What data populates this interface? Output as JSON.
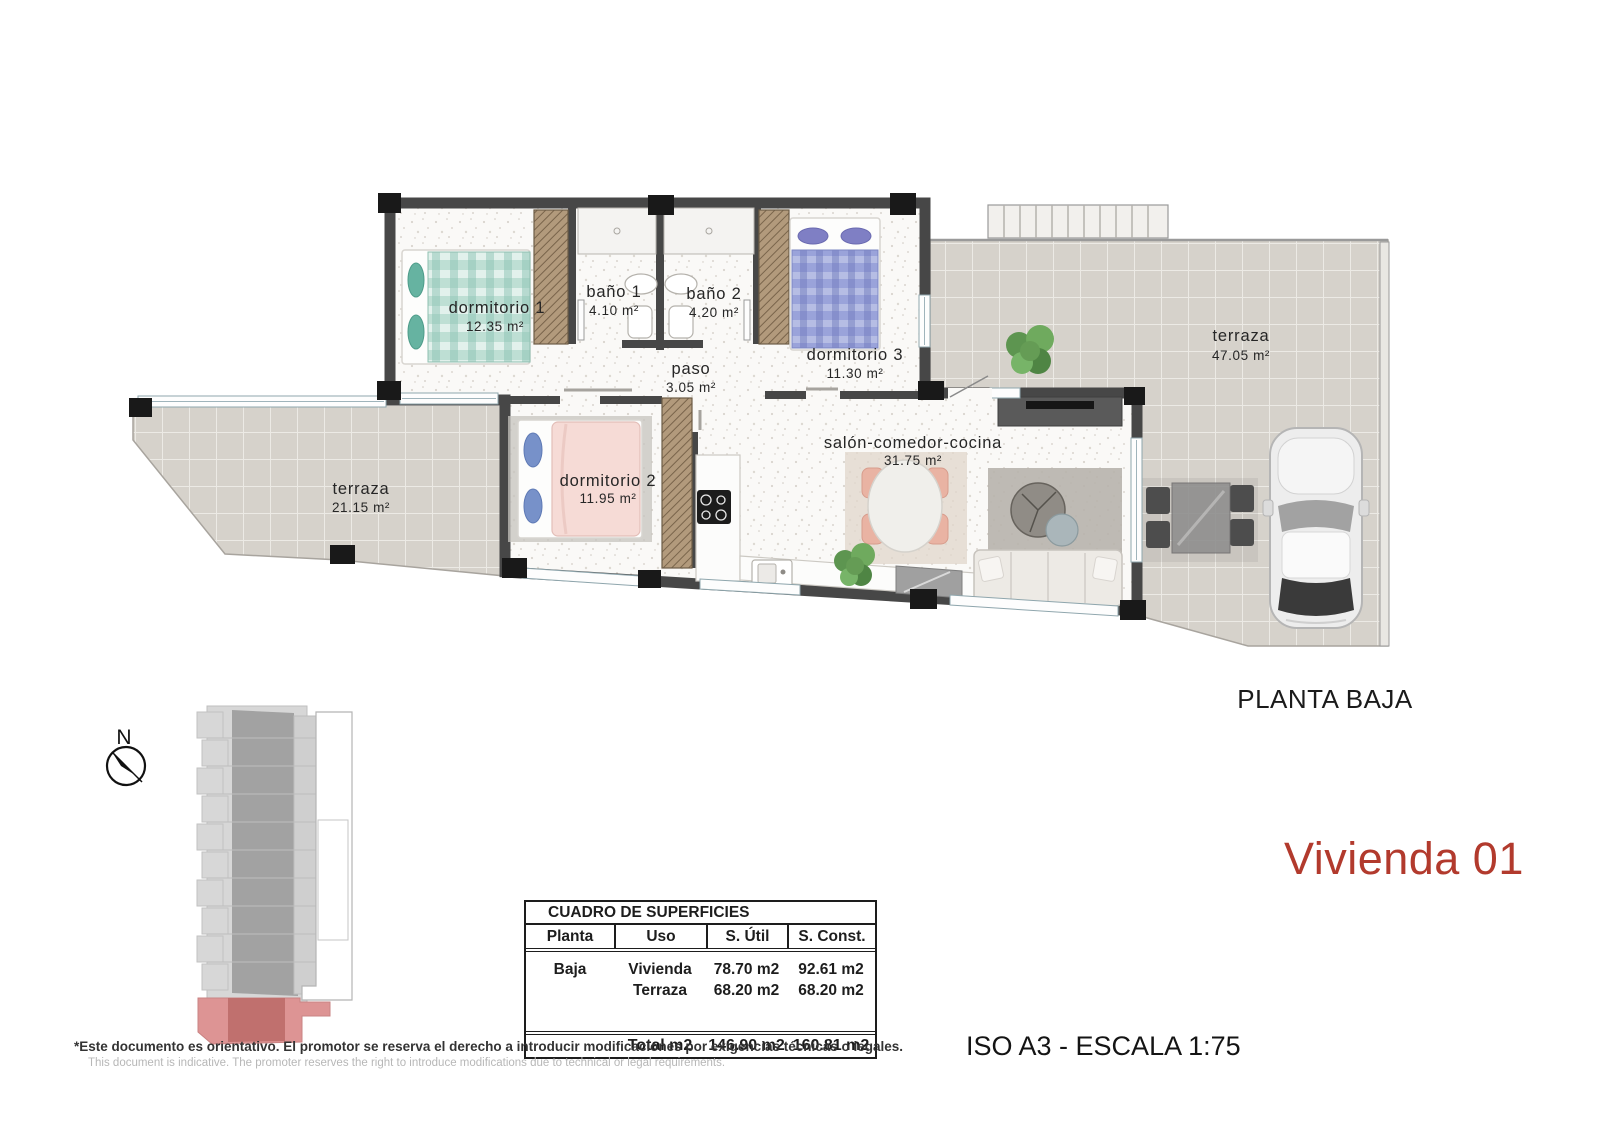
{
  "plan": {
    "compass": "N",
    "floor_label": "PLANTA BAJA",
    "unit_label": "Vivienda 01",
    "scale_label": "ISO A3 - ESCALA 1:75",
    "rooms": [
      {
        "name": "dormitorio  1",
        "area": "12.35  m²"
      },
      {
        "name": "baño  1",
        "area": "4.10  m²"
      },
      {
        "name": "baño  2",
        "area": "4.20  m²"
      },
      {
        "name": "paso",
        "area": "3.05  m²"
      },
      {
        "name": "dormitorio  3",
        "area": "11.30  m²"
      },
      {
        "name": "dormitorio  2",
        "area": "11.95  m²"
      },
      {
        "name": "salón-comedor-cocina",
        "area": "31.75  m²"
      },
      {
        "name": "terraza",
        "area": "21.15  m²"
      },
      {
        "name": "terraza",
        "area": "47.05  m²"
      }
    ]
  },
  "surface_table": {
    "title": "CUADRO DE SUPERFICIES",
    "headers": [
      "Planta",
      "Uso",
      "S. Útil",
      "S. Const."
    ],
    "rows": [
      {
        "planta": "Baja",
        "uso": "Vivienda",
        "util": "78.70 m2",
        "const": "92.61 m2"
      },
      {
        "planta": "",
        "uso": "Terraza",
        "util": "68.20 m2",
        "const": "68.20 m2"
      }
    ],
    "total": {
      "planta": "",
      "label": "Total m2",
      "util": "146.90 m2",
      "const": "160.81 m2"
    }
  },
  "footer": {
    "disclaimer_es": "*Este documento es orientativo. El promotor se reserva el derecho a introducir modificaciones por exigencias técnicas o legales.",
    "disclaimer_en": "This document is indicative. The promoter reserves the right to introduce modifications due to technical or legal requirements."
  },
  "colors": {
    "accent_red": "#b23a2d",
    "wall": "#474747",
    "tile": "#d6d2cb",
    "highlight_unit": "#c0706e"
  }
}
